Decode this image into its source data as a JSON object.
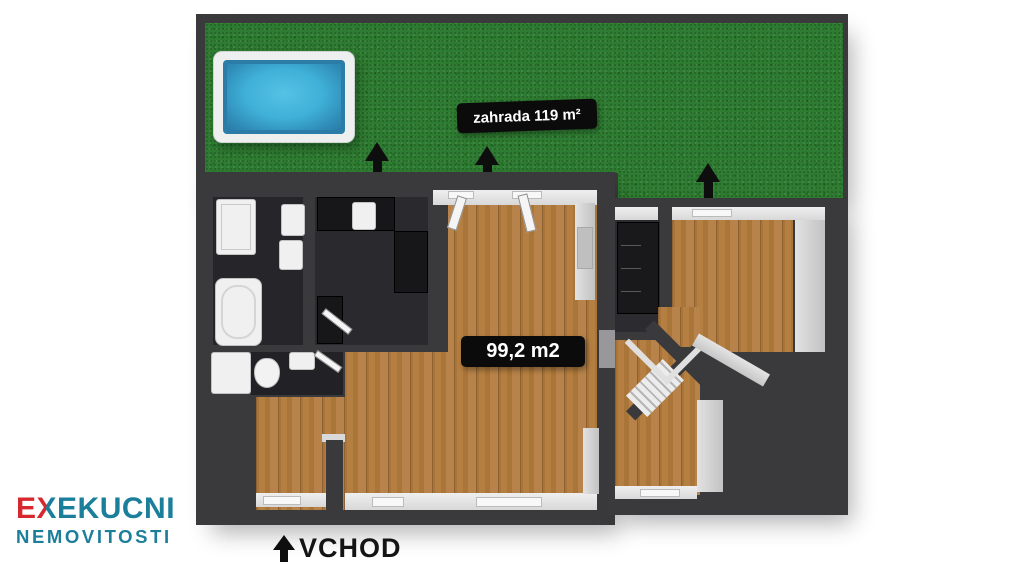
{
  "garden": {
    "label": "zahrada 119 m²"
  },
  "building": {
    "area_label": "99,2 m2"
  },
  "entrance": {
    "label": "VCHOD"
  },
  "logo": {
    "e": "E",
    "x": "X",
    "rest": "EKUCNI",
    "line2": "NEMOVITOSTI"
  },
  "colors": {
    "grass_green": "#2e7c31",
    "pool_water_blue": "#3fb0d8",
    "wood_brown": "#ae793c",
    "wall_dark": "#3a3a3c",
    "label_bg_black": "#0b0b0b",
    "logo_red": "#d7282e",
    "logo_teal": "#1b7e9a"
  }
}
